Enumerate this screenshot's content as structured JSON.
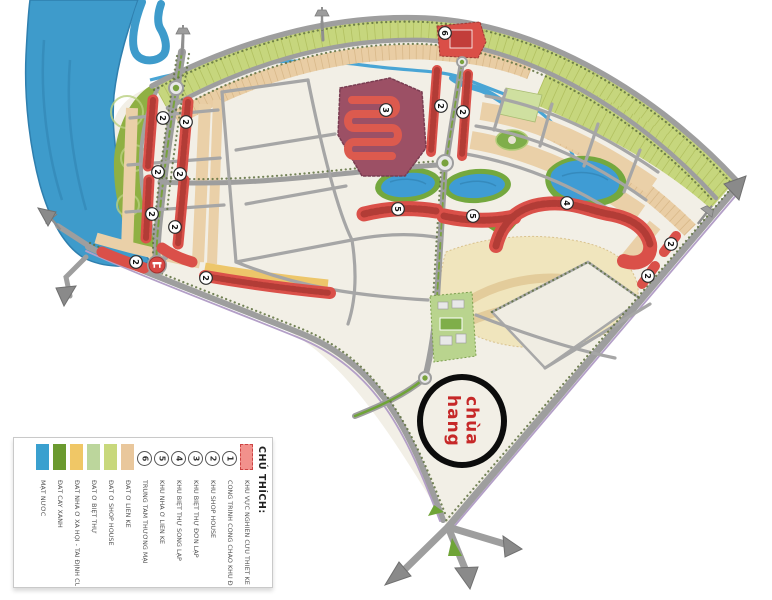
{
  "annotation": {
    "line1": "chùa",
    "line2": "hang",
    "color": "#c62828"
  },
  "legend": {
    "title": "CHÚ THÍCH:",
    "items": [
      {
        "type": "swatch-dashed",
        "color": "#f2918c",
        "border": "#cc4444",
        "label": "KHU VỰC NGHIÊN CỨU THIẾT KẾ"
      },
      {
        "type": "number",
        "num": "1",
        "label": "CÔNG TRÌNH CỔNG CHÀO KHU ĐÔ THỊ"
      },
      {
        "type": "number",
        "num": "2",
        "label": "KHU SHOP HOUSE"
      },
      {
        "type": "number",
        "num": "3",
        "label": "KHU BIỆT THỰ ĐƠN LẬP"
      },
      {
        "type": "number",
        "num": "4",
        "label": "KHU BIỆT THỰ SONG LẬP"
      },
      {
        "type": "number",
        "num": "5",
        "label": "KHU NHÀ Ở LIỀN KỀ"
      },
      {
        "type": "number",
        "num": "6",
        "label": "TRUNG TÂM THƯƠNG MẠI"
      },
      {
        "type": "swatch",
        "color": "#e9c79c",
        "label": "ĐẤT Ở LIỀN KỀ"
      },
      {
        "type": "swatch",
        "color": "#c8d87c",
        "label": "ĐẤT Ở SHOP HOUSE"
      },
      {
        "type": "swatch",
        "color": "#bcd69c",
        "label": "ĐẤT Ở BIỆT THỰ"
      },
      {
        "type": "swatch",
        "color": "#f0c766",
        "label": "ĐẤT NHÀ Ở XÃ HỘI - TÁI ĐỊNH CƯ"
      },
      {
        "type": "swatch",
        "color": "#6b9a2f",
        "label": "ĐẤT CÂY XANH"
      },
      {
        "type": "swatch",
        "color": "#3aa0cf",
        "label": "MẶT NƯỚC"
      }
    ]
  },
  "map": {
    "markers": [
      {
        "label": "2",
        "x": 163,
        "y": 118
      },
      {
        "label": "2",
        "x": 186,
        "y": 122
      },
      {
        "label": "2",
        "x": 158,
        "y": 172
      },
      {
        "label": "2",
        "x": 180,
        "y": 174
      },
      {
        "label": "2",
        "x": 152,
        "y": 214
      },
      {
        "label": "2",
        "x": 175,
        "y": 227
      },
      {
        "label": "2",
        "x": 136,
        "y": 262
      },
      {
        "label": "2",
        "x": 206,
        "y": 278
      },
      {
        "label": "2",
        "x": 441,
        "y": 106
      },
      {
        "label": "2",
        "x": 463,
        "y": 112
      },
      {
        "label": "2",
        "x": 671,
        "y": 244
      },
      {
        "label": "2",
        "x": 648,
        "y": 276
      },
      {
        "label": "3",
        "x": 386,
        "y": 110
      },
      {
        "label": "4",
        "x": 567,
        "y": 203
      },
      {
        "label": "5",
        "x": 398,
        "y": 209
      },
      {
        "label": "5",
        "x": 473,
        "y": 216
      },
      {
        "label": "6",
        "x": 445,
        "y": 33
      }
    ],
    "gateway_marker": {
      "x": 157,
      "y": 265,
      "icon": "gateway-arch"
    },
    "colors": {
      "water": "#3e9bcb",
      "greenery": "#8fb043",
      "boundary_strip": "#c6d67d",
      "residential_tan": "#ead0a8",
      "highlight_red": "#da5049",
      "villa_block_purple": "#9c5065",
      "road_gray": "#9e9e9e",
      "base_cream": "#f2efe6"
    }
  }
}
